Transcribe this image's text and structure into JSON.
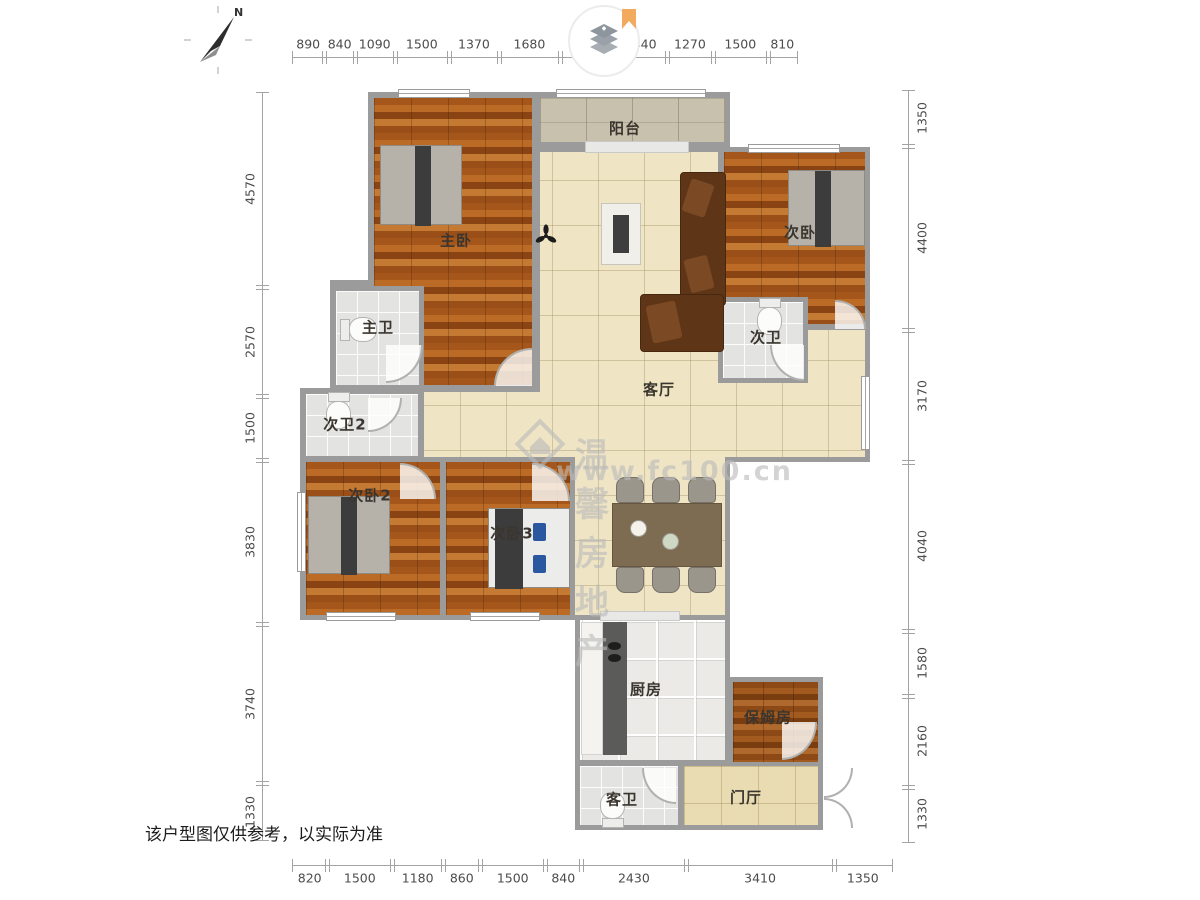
{
  "page": {
    "disclaimer": "该户型图仅供参考，以实际为准"
  },
  "compass": {
    "north_label": "N"
  },
  "brand": {
    "watermark_name": "温馨房地产",
    "watermark_url": "www.fc100.cn"
  },
  "rooms": {
    "balcony": "阳台",
    "master_bedroom": "主卧",
    "bedroom2": "次卧",
    "master_bath": "主卫",
    "bath2": "次卫",
    "bath3": "次卫2",
    "bedroom3": "次卧2",
    "bedroom4": "次卧3",
    "living": "客厅",
    "kitchen": "厨房",
    "maid_room": "保姆房",
    "guest_bath": "客卫",
    "foyer": "门厅"
  },
  "dimensions": {
    "top": [
      890,
      840,
      1090,
      1500,
      1370,
      1680,
      1500,
      1440,
      1270,
      1500,
      810
    ],
    "bottom": [
      820,
      1500,
      1180,
      860,
      1500,
      840,
      2430,
      3410,
      1350
    ],
    "left": [
      4570,
      2570,
      1500,
      3830,
      3740,
      1330
    ],
    "right": [
      1350,
      4400,
      3170,
      4040,
      1580,
      2160,
      1330
    ]
  },
  "colors": {
    "wall": "#9b9b9b",
    "wood_floor": "#a8581c",
    "tile_cream": "#efe4c4",
    "tile_stone": "#c8c1ae",
    "tile_bath": "#e3e3e1",
    "tile_foyer": "#e9dcb2",
    "ribbon_orange": "#f2ab5e"
  }
}
